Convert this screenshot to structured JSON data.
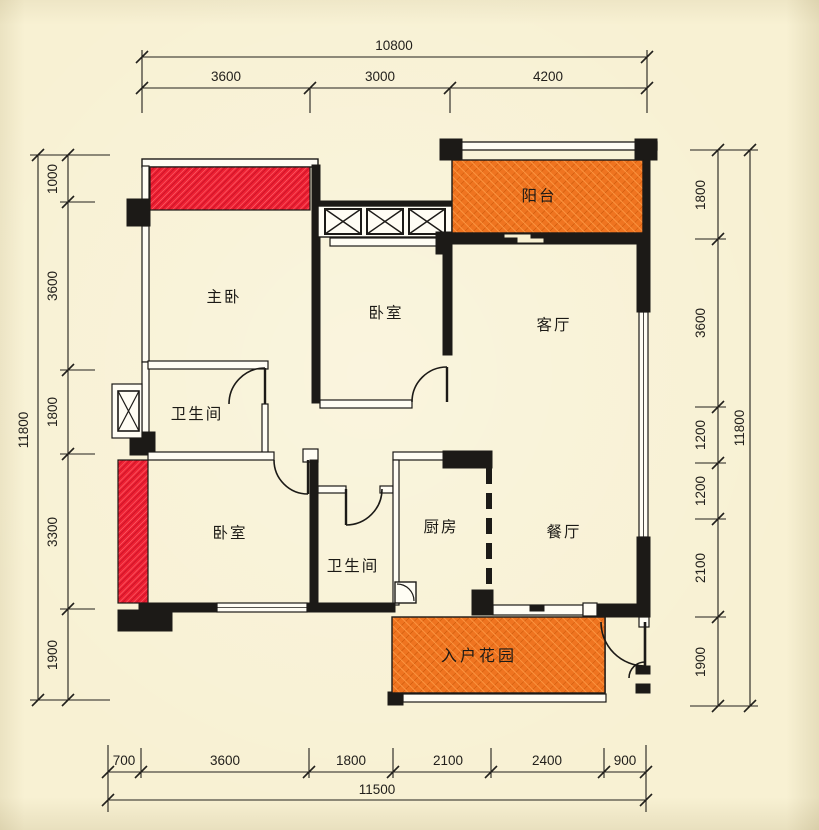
{
  "title": "apartment-floor-plan",
  "colors": {
    "background": "#f8f1d3",
    "wall": "#1c1a17",
    "bay_window_red": "#ee2133",
    "garden_balcony_orange": "#ef7420",
    "dim_line": "#2a2722"
  },
  "rooms": {
    "master_bedroom": "主卧",
    "bedroom_top": "卧室",
    "living_room": "客厅",
    "balcony": "阳台",
    "bathroom_main": "卫生间",
    "bedroom_left": "卧室",
    "bathroom_second": "卫生间",
    "kitchen": "厨房",
    "dining_room": "餐厅",
    "entry_garden": "入户花园"
  },
  "dimensions": {
    "top": {
      "total": "10800",
      "segments": [
        "3600",
        "3000",
        "4200"
      ]
    },
    "bottom": {
      "total": "11500",
      "segments": [
        "700",
        "3600",
        "1800",
        "2100",
        "2400",
        "900"
      ]
    },
    "left": {
      "total": "11800",
      "segments": [
        "1000",
        "3600",
        "1800",
        "3300",
        "1900"
      ]
    },
    "right": {
      "total": "11800",
      "segments": [
        "1800",
        "3600",
        "1200",
        "1200",
        "2100",
        "1900"
      ]
    }
  }
}
